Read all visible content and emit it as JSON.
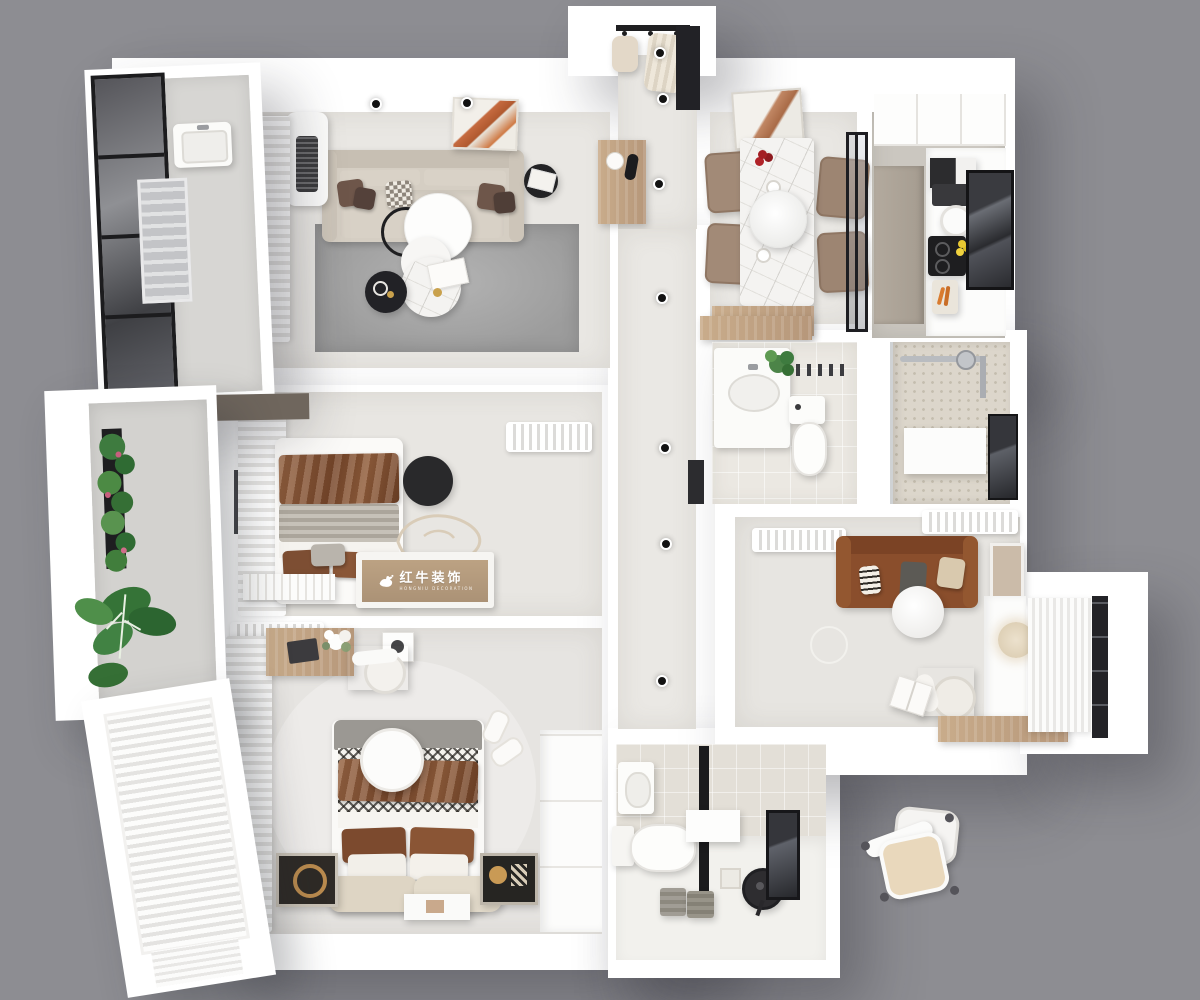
{
  "watermark": {
    "logo": "bull-icon",
    "brand": "红牛装饰",
    "brand_latin": "HONGNIU DECORATION"
  },
  "palette": {
    "background": "#8d8d92",
    "wall_white": "#ffffff",
    "floor_light": "#e9e7e3",
    "floor_warm": "#f1f0ec",
    "rug_gray": "#a7a7a7",
    "sofa_beige": "#d5cec3",
    "sofa_brown": "#8a4e2c",
    "blanket_rust": "#84512f",
    "wood": "#c0a285",
    "black_accent": "#222226",
    "marble": "#f4f3f1",
    "tile": "#ebe8e2",
    "shower_tile": "#dcd6cb",
    "plant_green": "#3e7b3f",
    "glass_dark": "#45464b",
    "cushion_tan": "#e9d8bc",
    "berry_red": "#a31f24",
    "lemon_yellow": "#e8c832",
    "carrot_orange": "#d97b2f",
    "gold": "#c9a14c"
  }
}
